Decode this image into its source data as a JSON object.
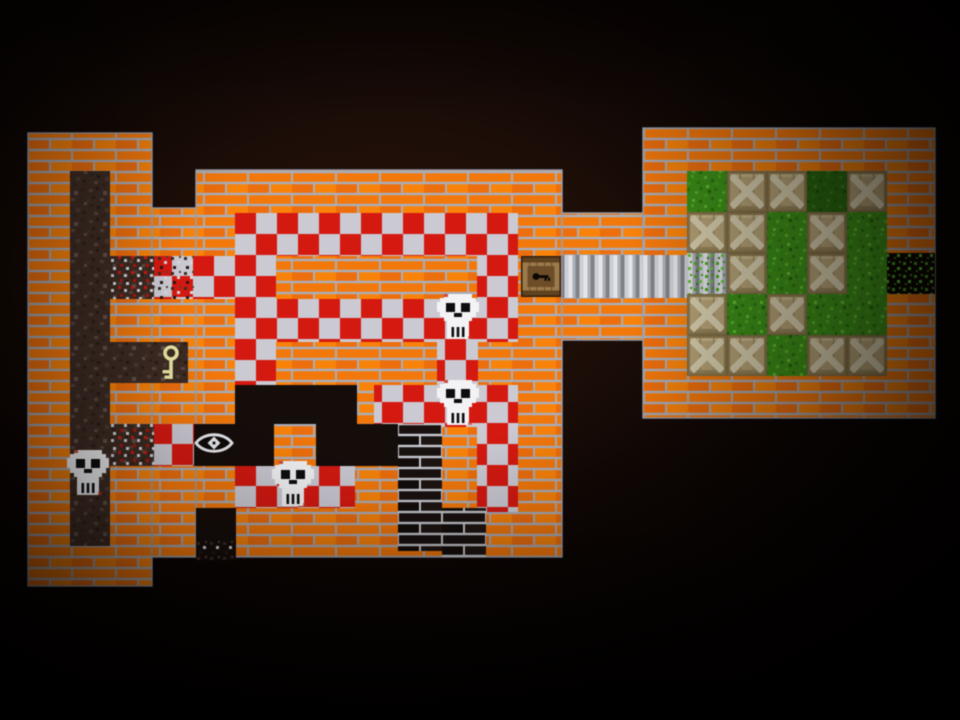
{
  "scene": {
    "name": "top-down dungeon tile map",
    "background": "#000000"
  },
  "palette": {
    "brick_orange": "#f0790f",
    "brick_mortar": "#a9aebb",
    "dark_brick": "#181110",
    "dark_brick_mortar": "#c9cbd1",
    "checker_red": "#d01a12",
    "checker_white": "#cbcad3",
    "dirt": "#3c2b23",
    "grass": "#3e8f1b",
    "metal": "#cdcfd6",
    "black_floor": "#140d0a",
    "crate": "#b5a378",
    "skull": "#f3f3f6",
    "key": "#e7e4a4",
    "door_wood": "#9a7a4c"
  },
  "legend": {
    "skull_count": 4,
    "crate_count": 14,
    "key_count": 1,
    "door_count": 1,
    "eye_count": 1,
    "rooms": [
      "left dirt shaft",
      "checkered hall",
      "dark eye room",
      "metal corridor",
      "crate room"
    ],
    "exits": [
      "east opening from crate room",
      "south opening below eye room"
    ]
  },
  "icons": {
    "skull": "skull-icon",
    "crate": "crate-icon",
    "key": "key-icon",
    "eye": "eye-icon",
    "door": "door-icon"
  },
  "walls": [
    {
      "id": "left-tower",
      "x": 28,
      "y": 133,
      "w": 124,
      "h": 453
    },
    {
      "id": "left-junction",
      "x": 152,
      "y": 208,
      "w": 44,
      "h": 349
    },
    {
      "id": "main-hall",
      "x": 196,
      "y": 170,
      "w": 366,
      "h": 387
    },
    {
      "id": "corridor-top-wall",
      "x": 562,
      "y": 213,
      "w": 81,
      "h": 42
    },
    {
      "id": "corridor-bottom-wall",
      "x": 562,
      "y": 298,
      "w": 81,
      "h": 42
    },
    {
      "id": "crate-room",
      "x": 643,
      "y": 128,
      "w": 292,
      "h": 290
    }
  ],
  "floors": [
    {
      "id": "dirt-shaft",
      "type": "dirt",
      "x": 70,
      "y": 171,
      "w": 40,
      "h": 375
    },
    {
      "id": "key-nook",
      "type": "dirt",
      "x": 110,
      "y": 342,
      "w": 78,
      "h": 41
    },
    {
      "id": "west-pass-dirt",
      "type": "dirt_speckle",
      "x": 110,
      "y": 256,
      "w": 44,
      "h": 43
    },
    {
      "id": "west-pass-mixed",
      "type": "checker_speckle",
      "x": 154,
      "y": 256,
      "w": 42,
      "h": 43
    },
    {
      "id": "west-pass-tile",
      "type": "checker",
      "x": 196,
      "y": 256,
      "w": 80,
      "h": 43
    },
    {
      "id": "band-top",
      "type": "checker",
      "x": 235,
      "y": 213,
      "w": 283,
      "h": 43
    },
    {
      "id": "door-landing",
      "type": "checker",
      "x": 477,
      "y": 256,
      "w": 41,
      "h": 43
    },
    {
      "id": "band-second",
      "type": "checker",
      "x": 235,
      "y": 299,
      "w": 283,
      "h": 43
    },
    {
      "id": "left-path",
      "type": "checker",
      "x": 235,
      "y": 342,
      "w": 41,
      "h": 43
    },
    {
      "id": "skull-path",
      "type": "checker",
      "x": 437,
      "y": 342,
      "w": 41,
      "h": 43
    },
    {
      "id": "band-third",
      "type": "checker",
      "x": 374,
      "y": 385,
      "w": 144,
      "h": 42
    },
    {
      "id": "right-path",
      "type": "checker",
      "x": 477,
      "y": 427,
      "w": 41,
      "h": 85
    },
    {
      "id": "dark-room-a",
      "type": "black",
      "x": 235,
      "y": 385,
      "w": 122,
      "h": 42
    },
    {
      "id": "dark-room-b",
      "type": "black",
      "x": 194,
      "y": 424,
      "w": 204,
      "h": 42
    },
    {
      "id": "eye-pass-dirt",
      "type": "dirt_speckle",
      "x": 110,
      "y": 424,
      "w": 44,
      "h": 42
    },
    {
      "id": "eye-pass-checker",
      "type": "checker",
      "x": 154,
      "y": 424,
      "w": 40,
      "h": 42
    },
    {
      "id": "room-pillar",
      "type": "brick",
      "x": 274,
      "y": 424,
      "w": 42,
      "h": 42
    },
    {
      "id": "band-bottom",
      "type": "checker",
      "x": 235,
      "y": 466,
      "w": 120,
      "h": 42
    },
    {
      "id": "south-exit",
      "type": "black",
      "x": 196,
      "y": 508,
      "w": 40,
      "h": 52
    },
    {
      "id": "south-exit-rubble",
      "type": "dirt_fade",
      "x": 196,
      "y": 541,
      "w": 40,
      "h": 19
    },
    {
      "id": "rubble-column",
      "type": "darkbrick",
      "x": 398,
      "y": 424,
      "w": 44,
      "h": 127
    },
    {
      "id": "rubble-foot",
      "type": "darkbrick",
      "x": 442,
      "y": 508,
      "w": 44,
      "h": 49
    },
    {
      "id": "corridor-floor",
      "type": "metal",
      "x": 562,
      "y": 255,
      "w": 125,
      "h": 43
    },
    {
      "id": "crate-room-grass",
      "type": "grass",
      "x": 687,
      "y": 171,
      "w": 200,
      "h": 205
    },
    {
      "id": "grass-dark-patch",
      "type": "grass_dark",
      "x": 807,
      "y": 171,
      "w": 40,
      "h": 41
    },
    {
      "id": "west-grass-ramp",
      "type": "metal_grass",
      "x": 687,
      "y": 253,
      "w": 40,
      "h": 41
    },
    {
      "id": "east-exit",
      "type": "black_grass",
      "x": 887,
      "y": 253,
      "w": 48,
      "h": 41
    }
  ],
  "entities": [
    {
      "type": "door",
      "id": "wooden-door",
      "x": 521,
      "y": 256
    },
    {
      "type": "key",
      "id": "gold-key",
      "x": 160,
      "y": 344
    },
    {
      "type": "eye",
      "id": "watcher-eye",
      "x": 194,
      "y": 429
    },
    {
      "type": "skull",
      "id": "skull-1",
      "x": 437,
      "y": 294
    },
    {
      "type": "skull",
      "id": "skull-2",
      "x": 437,
      "y": 380
    },
    {
      "type": "skull",
      "id": "skull-3",
      "x": 272,
      "y": 461
    },
    {
      "type": "skull",
      "id": "skull-4",
      "x": 67,
      "y": 450
    },
    {
      "type": "crate",
      "id": "crate-1",
      "x": 727,
      "y": 171
    },
    {
      "type": "crate",
      "id": "crate-2",
      "x": 767,
      "y": 171
    },
    {
      "type": "crate",
      "id": "crate-3",
      "x": 847,
      "y": 171
    },
    {
      "type": "crate",
      "id": "crate-4",
      "x": 687,
      "y": 212
    },
    {
      "type": "crate",
      "id": "crate-5",
      "x": 727,
      "y": 212
    },
    {
      "type": "crate",
      "id": "crate-6",
      "x": 807,
      "y": 212
    },
    {
      "type": "crate",
      "id": "crate-7",
      "x": 727,
      "y": 253
    },
    {
      "type": "crate",
      "id": "crate-8",
      "x": 807,
      "y": 253
    },
    {
      "type": "crate",
      "id": "crate-9",
      "x": 687,
      "y": 294
    },
    {
      "type": "crate",
      "id": "crate-10",
      "x": 767,
      "y": 294
    },
    {
      "type": "crate",
      "id": "crate-11",
      "x": 687,
      "y": 335
    },
    {
      "type": "crate",
      "id": "crate-12",
      "x": 727,
      "y": 335
    },
    {
      "type": "crate",
      "id": "crate-13",
      "x": 807,
      "y": 335
    },
    {
      "type": "crate",
      "id": "crate-14",
      "x": 847,
      "y": 335
    }
  ]
}
